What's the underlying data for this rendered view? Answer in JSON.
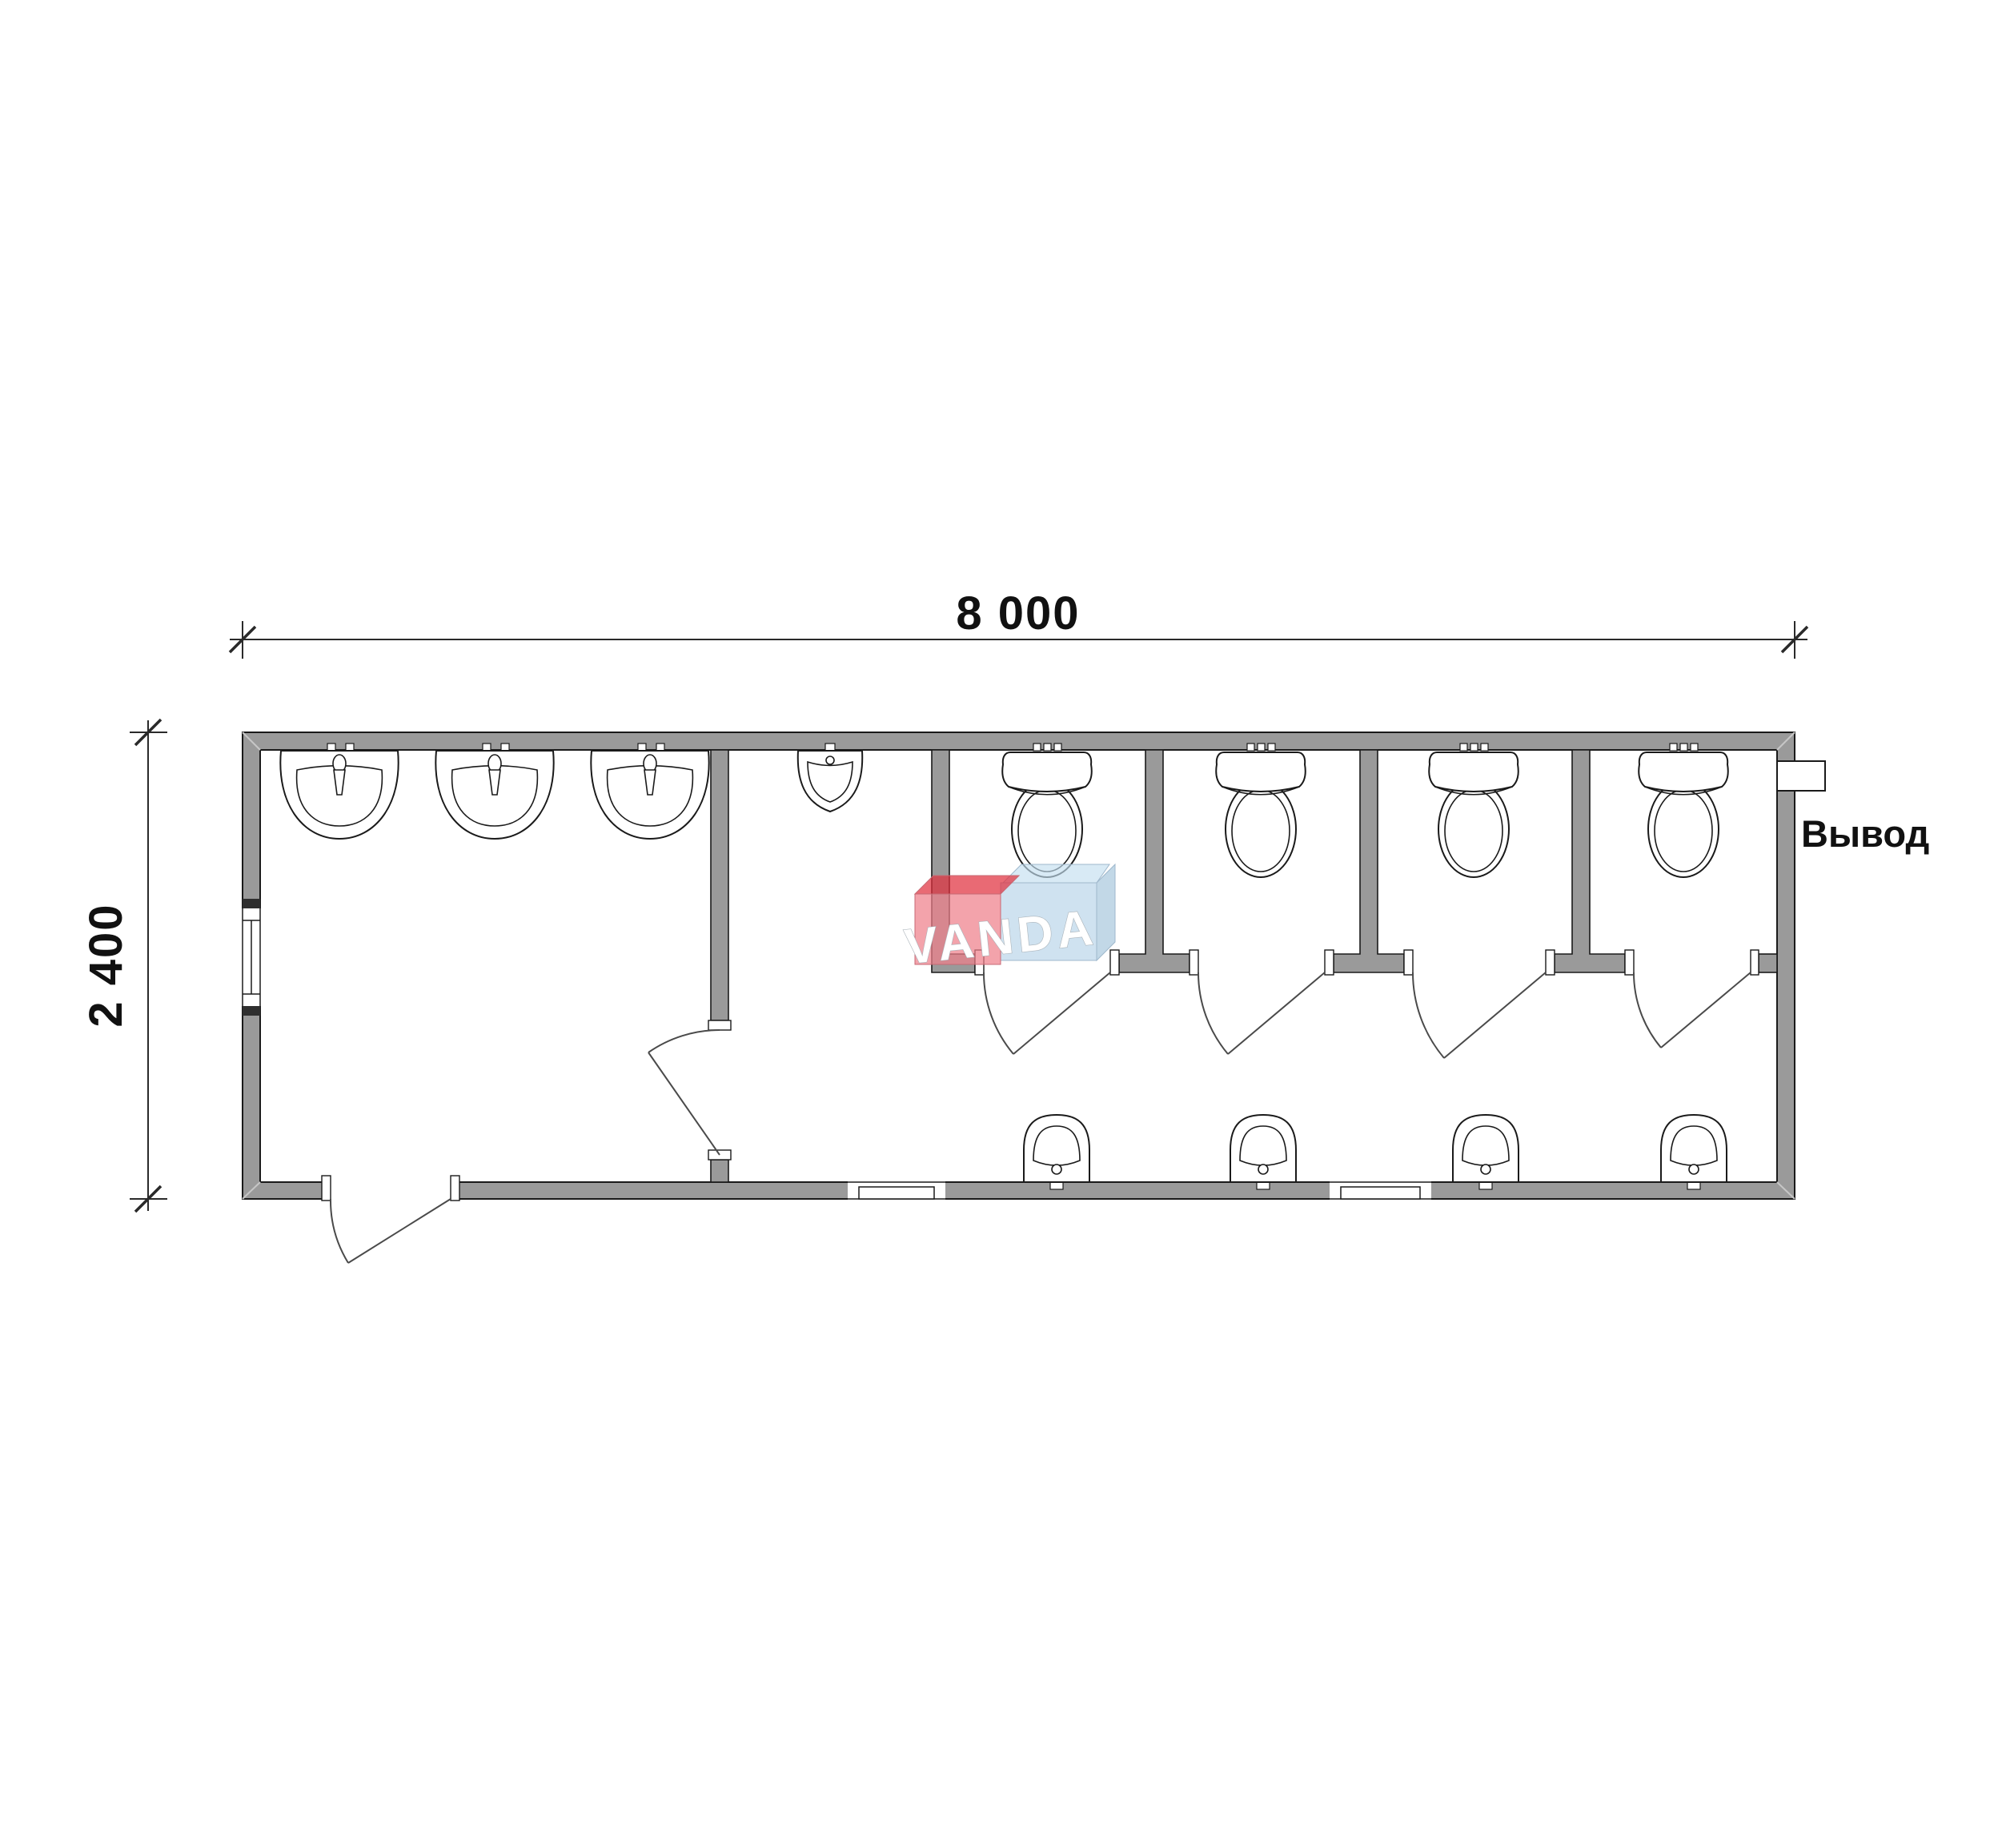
{
  "plan": {
    "type": "sanitary-module-floor-plan",
    "dimensions": {
      "width_label": "8 000",
      "height_label": "2 400"
    },
    "labels": {
      "outlet": "Вывод"
    },
    "watermark": {
      "text": "VANDA",
      "red_color": "#e4515f",
      "blue_color": "#a8cbe4"
    },
    "rooms": [
      {
        "name": "washroom",
        "fixtures": [
          "washbasin",
          "washbasin",
          "washbasin"
        ]
      },
      {
        "name": "urinal-area",
        "fixtures": [
          "urinal"
        ]
      },
      {
        "name": "wc-stall-1",
        "fixtures": [
          "toilet"
        ]
      },
      {
        "name": "wc-stall-2",
        "fixtures": [
          "toilet"
        ]
      },
      {
        "name": "wc-stall-3",
        "fixtures": [
          "toilet"
        ]
      },
      {
        "name": "wc-stall-4",
        "fixtures": [
          "toilet"
        ]
      },
      {
        "name": "corridor",
        "fixtures": [
          "hand-sink",
          "hand-sink",
          "hand-sink",
          "hand-sink"
        ]
      }
    ],
    "counts": {
      "washbasins": 3,
      "urinals": 1,
      "toilets": 4,
      "hand_sinks": 4,
      "doors": 6,
      "windows": 3
    },
    "colors": {
      "wall_fill": "#9a9a9a",
      "outline": "#1a1a1a",
      "door_line": "#4a4a4a",
      "background": "#ffffff",
      "dimension_text": "#000000"
    }
  }
}
